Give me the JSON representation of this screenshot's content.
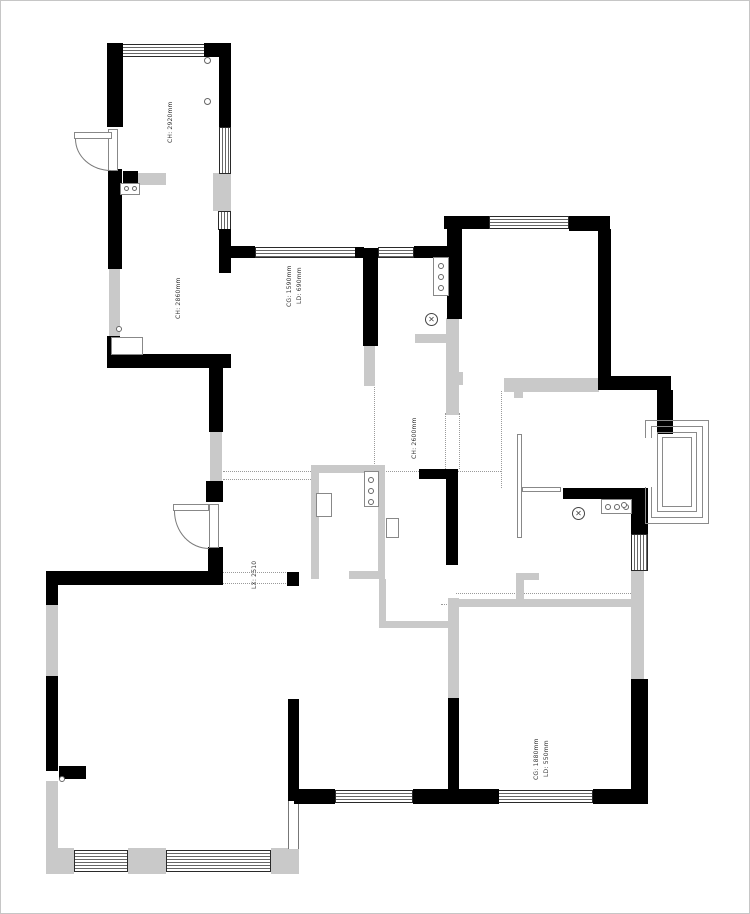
{
  "drawing": {
    "type": "residential-floor-plan",
    "annotations": {
      "room_a_upper_height": "CH: 2920mm",
      "room_a_lower_height": "CH: 2860mm",
      "corridor_window_height": "CG: 1590mm",
      "corridor_window_sill": "LD: 690mm",
      "hall_height": "CH: 2600mm",
      "hall_beam": "LX: 2510",
      "passage_beam": "LX: 2510",
      "bottom_right_window_height": "CG: 1880mm",
      "bottom_right_window_sill": "LD: 550mm"
    },
    "icons": {
      "lamp_glyph": "✕"
    },
    "colors": {
      "wall": "#000000",
      "light_wall": "#c9c9c9",
      "window_line": "#666666",
      "reference_line": "#9a9a9a",
      "background": "#ffffff"
    }
  }
}
